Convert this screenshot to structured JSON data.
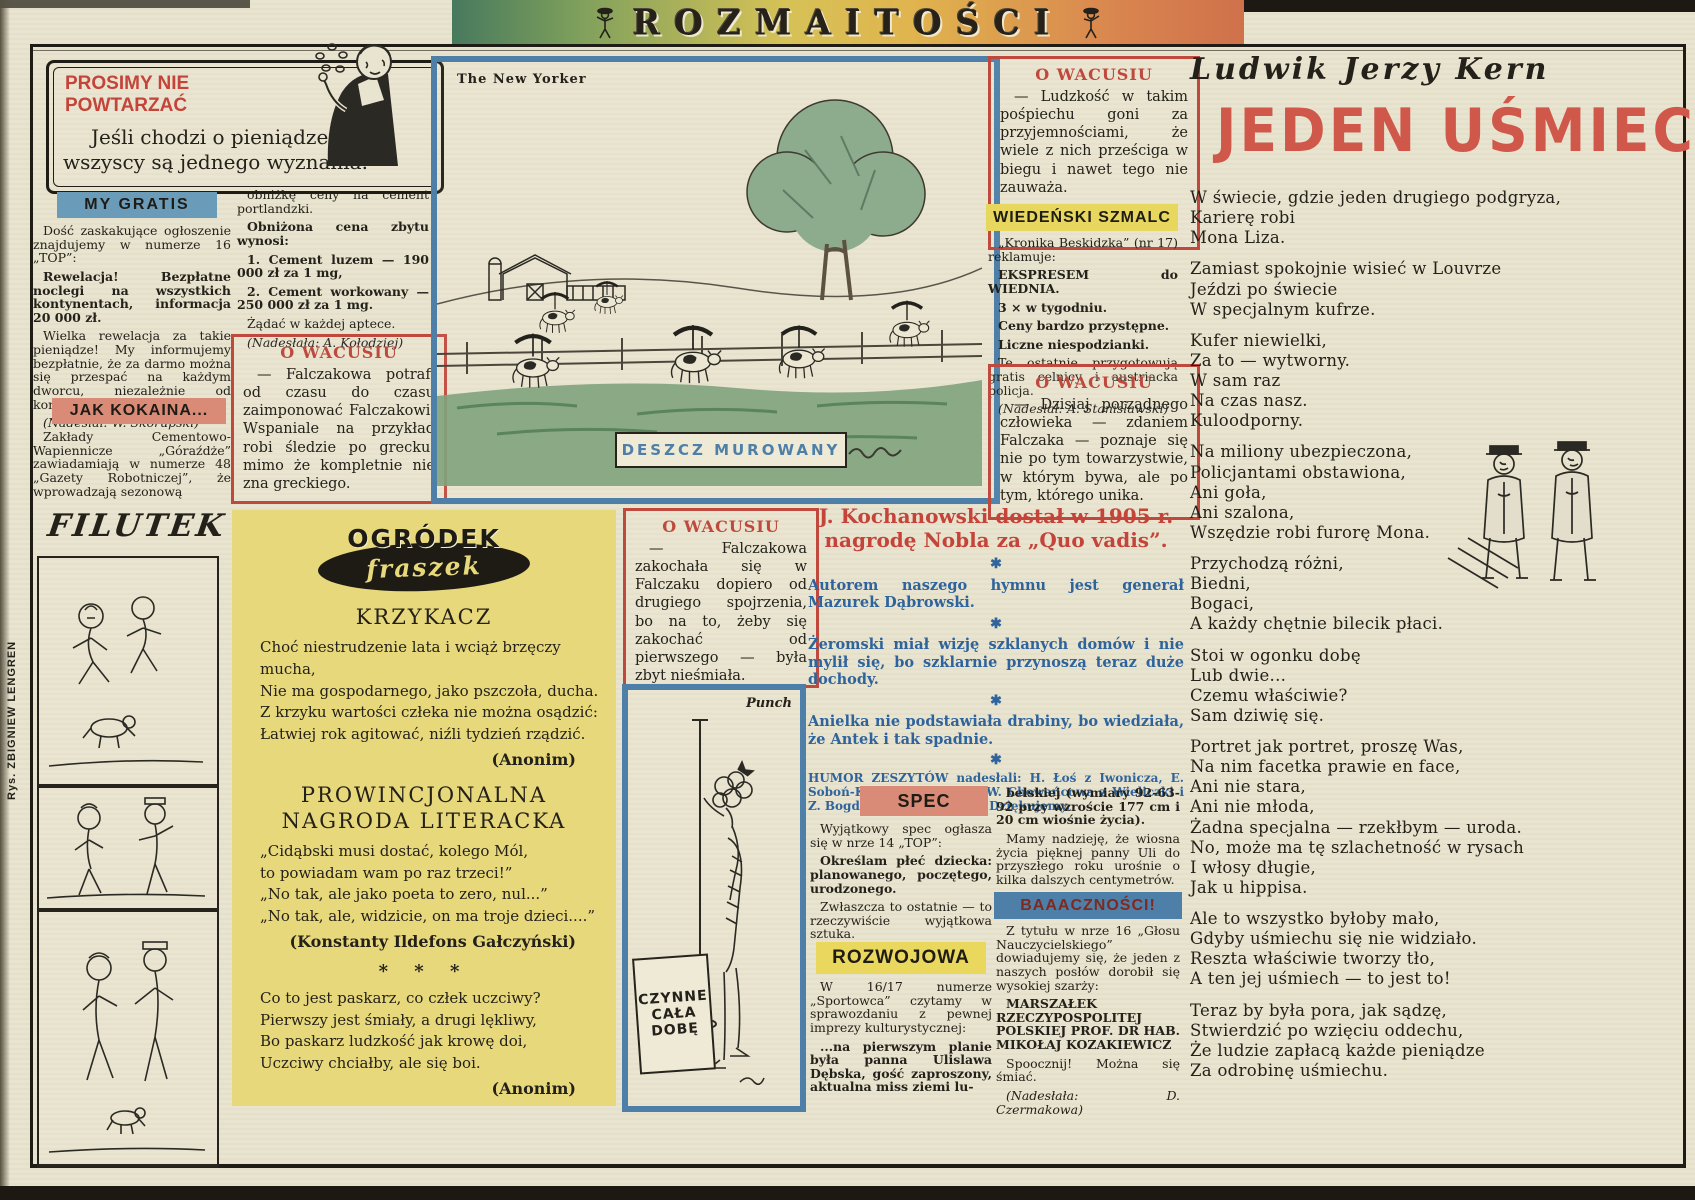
{
  "colors": {
    "red": "#c4443a",
    "blue_header": "#6a9cba",
    "salmon": "#d98b77",
    "yellow": "#e7d75e",
    "yellow_box": "#e8d87c",
    "blue_border": "#4d7fa8",
    "blue_text": "#2e639c"
  },
  "banner": {
    "title": "ROZMAITOŚCI"
  },
  "prosimy": {
    "title_line1": "PROSIMY NIE",
    "title_line2": "POWTARZAĆ",
    "text": "Jeśli chodzi o pieniądze, to wszyscy są jednego wyznania."
  },
  "my_gratis": {
    "header": "MY GRATIS",
    "paragraphs": [
      {
        "text": "Dość zaskakujące ogłoszenie znajdujemy w numerze 16 „TOP”:",
        "style": "normal"
      },
      {
        "text": "Rewelacja! Bezpłatne noclegi na wszystkich kontynentach, informacja 20 000 zł.",
        "style": "bold"
      },
      {
        "text": "Wielka rewelacja za takie pieniądze! My informujemy bezpłatnie, że za darmo można się przespać na każdym dworcu, niezależnie od kontynentu.",
        "style": "normal"
      },
      {
        "text": "(Nadesłał: W. Skorupski)",
        "style": "italic"
      }
    ]
  },
  "jak_kokaina": {
    "header": "JAK KOKAINA...",
    "paragraphs": [
      {
        "text": "Zakłady Cementowo-Wapiennicze „Góraźdże” zawiadamiają w numerze 48 „Gazety Robotniczej”, że wprowadzają sezonową",
        "style": "normal"
      }
    ]
  },
  "cement": {
    "paragraphs": [
      {
        "text": "obniżkę ceny na cement portlandzki.",
        "style": "normal"
      },
      {
        "text": "Obniżona cena zbytu wynosi:",
        "style": "bold"
      },
      {
        "text": "1. Cement luzem — 190 000 zł za 1 mg,",
        "style": "bold"
      },
      {
        "text": "2. Cement workowany — 250 000 zł za 1 mg.",
        "style": "bold"
      },
      {
        "text": "Żądać w każdej aptece.",
        "style": "normal"
      },
      {
        "text": "(Nadesłała: A. Kołodziej)",
        "style": "italic"
      }
    ]
  },
  "wacusiu": {
    "header": "O WACUSIU",
    "box1": "— Falczakowa potrafi od czasu do czasu zaimponować Falczakowi. Wspaniale na przykład robi śledzie po grecku, mimo że kompletnie nie zna greckiego.",
    "box2": "— Ludzkość w takim pośpiechu goni za przyjemnościami, że wiele z nich prześciga w biegu i nawet tego nie zauważa.",
    "box3": "— Dzisiaj porządnego człowieka — zdaniem Falczaka — poznaje się nie po tym towarzystwie, w którym bywa, ale po tym, którego unika.",
    "box4": "— Falczakowa zakochała się w Falczaku dopiero od drugiego spojrzenia, bo na to, żeby się zakochać od pierwszego — była zbyt nieśmiała."
  },
  "wiedenski": {
    "header": "WIEDEŃSKI SZMALC",
    "paragraphs": [
      {
        "text": "„Kronika Beskidzka” (nr 17) reklamuje:",
        "style": "normal"
      },
      {
        "text": "EKSPRESEM do WIEDNIA.",
        "style": "bold"
      },
      {
        "text": "3 × w tygodniu.",
        "style": "bold"
      },
      {
        "text": "Ceny bardzo przystępne.",
        "style": "bold"
      },
      {
        "text": "Liczne niespodzianki.",
        "style": "bold"
      },
      {
        "text": "Te ostatnie przygotowują gratis celnicy i austriacka policja.",
        "style": "normal"
      },
      {
        "text": "(Nadesłał: A. Stanisławski)",
        "style": "italic"
      }
    ]
  },
  "newyorker": {
    "label": "The New Yorker",
    "caption": "DESZCZ MUROWANY"
  },
  "punch": {
    "label": "Punch",
    "sign": [
      "CZYNNE",
      "CAŁA",
      "DOBĘ"
    ]
  },
  "fraszki": {
    "logo_top": "OGRÓDEK",
    "logo_bottom": "fraszek",
    "krzykacz_title": "KRZYKACZ",
    "krzykacz_lines": [
      "Choć niestrudzenie lata i wciąż brzęczy mucha,",
      "Nie ma gospodarnego, jako pszczoła, ducha.",
      "Z krzyku wartości człeka nie można osądzić:",
      "Łatwiej rok agitować, niźli tydzień rządzić."
    ],
    "krzykacz_credit": "(Anonim)",
    "prow_title1": "PROWINCJONALNA",
    "prow_title2": "NAGRODA LITERACKA",
    "prow_lines": [
      "„Cidąbski musi dostać, kolego Mól,",
      "to powiadam wam po raz trzeci!”",
      "„No tak, ale jako poeta to zero, nul...”",
      "„No tak, ale, widzicie, on ma troje dzieci....”"
    ],
    "prow_credit": "(Konstanty Ildefons Gałczyński)",
    "stars": "* * *",
    "paskarz_lines": [
      "Co to jest paskarz, co człek uczciwy?",
      "Pierwszy jest śmiały, a drugi lękliwy,",
      "Bo paskarz ludzkość jak krowę doi,",
      "Uczciwy chciałby, ale się boi."
    ],
    "paskarz_credit": "(Anonim)"
  },
  "humor": {
    "headline1": "J. Kochanowski dostał w 1905 r.",
    "headline2": "nagrodę Nobla za „Quo vadis”.",
    "jokes": [
      "Autorem naszego hymnu jest generał Mazurek Dąbrowski.",
      "Żeromski miał wizję szklanych domów i nie mylił się, bo szklarnie przynoszą teraz duże dochody.",
      "Anielka nie podstawiała drabiny, bo wiedziała, że Antek i tak spadnie."
    ],
    "credits": "HUMOR ZESZYTÓW nadesłali: H. Łoś z Iwonicza, E. Soboń-Kidawa z Będzina, W. Chowańcowa z Wieliczki i Z. Bogdański z Wrocławia. Dziękujemy."
  },
  "spec": {
    "header": "SPEC",
    "paragraphs": [
      {
        "text": "Wyjątkowy spec ogłasza się w nrze 14 „TOP”:",
        "style": "normal"
      },
      {
        "text": "Określam płeć dziecka: planowanego, poczętego, urodzonego.",
        "style": "bold"
      },
      {
        "text": "Zwłaszcza to ostatnie — to rzeczywiście wyjątkowa sztuka.",
        "style": "normal"
      },
      {
        "text": "(Nadesłał: W. Skorupski)",
        "style": "italic"
      }
    ]
  },
  "rozwojowa": {
    "header": "ROZWOJOWA",
    "paragraphs": [
      {
        "text": "W 16/17 numerze „Sportowca” czytamy w sprawozdaniu z pewnej imprezy kulturystycznej:",
        "style": "normal"
      },
      {
        "text": "...na pierwszym planie była panna Ulislawa Dębska, gość zaproszony, aktualna miss ziemi lu-",
        "style": "bold"
      }
    ]
  },
  "belska": {
    "paragraphs": [
      {
        "text": "belskiej (wymiary 92-63-92 przy wzroście 177 cm i 20 cm wiośnie życia).",
        "style": "bold"
      },
      {
        "text": "Mamy nadzieję, że wiosna życia pięknej panny Uli do przyszłego roku urośnie o kilka dalszych centymetrów.",
        "style": "normal"
      },
      {
        "text": "(Nadesłał: A. Woźniak)",
        "style": "italic"
      }
    ]
  },
  "baacznosci": {
    "header": "BAAACZNOŚCI!",
    "paragraphs": [
      {
        "text": "Z tytułu w nrze 16 „Głosu Nauczycielskiego” dowiadujemy się, że jeden z naszych posłów dorobił się wysokiej szarży:",
        "style": "normal"
      },
      {
        "text": "MARSZAŁEK RZECZYPOSPOLITEJ POLSKIEJ PROF. DR HAB. MIKOŁAJ KOZAKIEWICZ",
        "style": "bold"
      },
      {
        "text": "Spoocznij! Można się śmiać.",
        "style": "normal"
      },
      {
        "text": "(Nadesłała: D. Czermakowa)",
        "style": "italic"
      }
    ]
  },
  "kern": {
    "name": "Ludwik Jerzy Kern",
    "title": "JEDEN UŚMIECH",
    "stanzas": [
      [
        "W świecie, gdzie jeden drugiego podgryza,",
        "Karierę robi",
        "Mona Liza."
      ],
      [
        "Zamiast spokojnie wisieć w Louvrze",
        "Jeździ po świecie",
        "W specjalnym kufrze."
      ],
      [
        "Kufer niewielki,",
        "Za to — wytworny.",
        "W sam raz",
        "Na czas nasz.",
        "Kuloodporny."
      ],
      [
        "Na miliony ubezpieczona,",
        "Policjantami obstawiona,",
        "Ani goła,",
        "Ani szalona,",
        "Wszędzie robi furorę Mona."
      ],
      [
        "Przychodzą różni,",
        "Biedni,",
        "Bogaci,",
        "A każdy chętnie bilecik płaci."
      ],
      [
        "Stoi w ogonku dobę",
        "Lub dwie...",
        "Czemu właściwie?",
        "Sam dziwię się."
      ],
      [
        "Portret jak portret, proszę Was,",
        "Na nim facetka prawie en face,",
        "Ani nie stara,",
        "Ani nie młoda,",
        "Żadna specjalna — rzekłbym — uroda.",
        "No, może ma tę szlachetność w rysach",
        "I włosy długie,",
        "Jak u hippisa."
      ],
      [
        "Ale to wszystko byłoby mało,",
        "Gdyby uśmiechu się nie widziało.",
        "Reszta właściwie tworzy tło,",
        "A ten jej uśmiech — to jest to!"
      ],
      [
        "Teraz by była pora, jak sądzę,",
        "Stwierdzić po wzięciu oddechu,",
        "Że ludzie zapłacą każde pieniądze",
        "Za odrobinę uśmiechu."
      ]
    ]
  },
  "filutek": {
    "title": "FILUTEK",
    "byline": "Rys. ZBIGNIEW LENGREN"
  }
}
